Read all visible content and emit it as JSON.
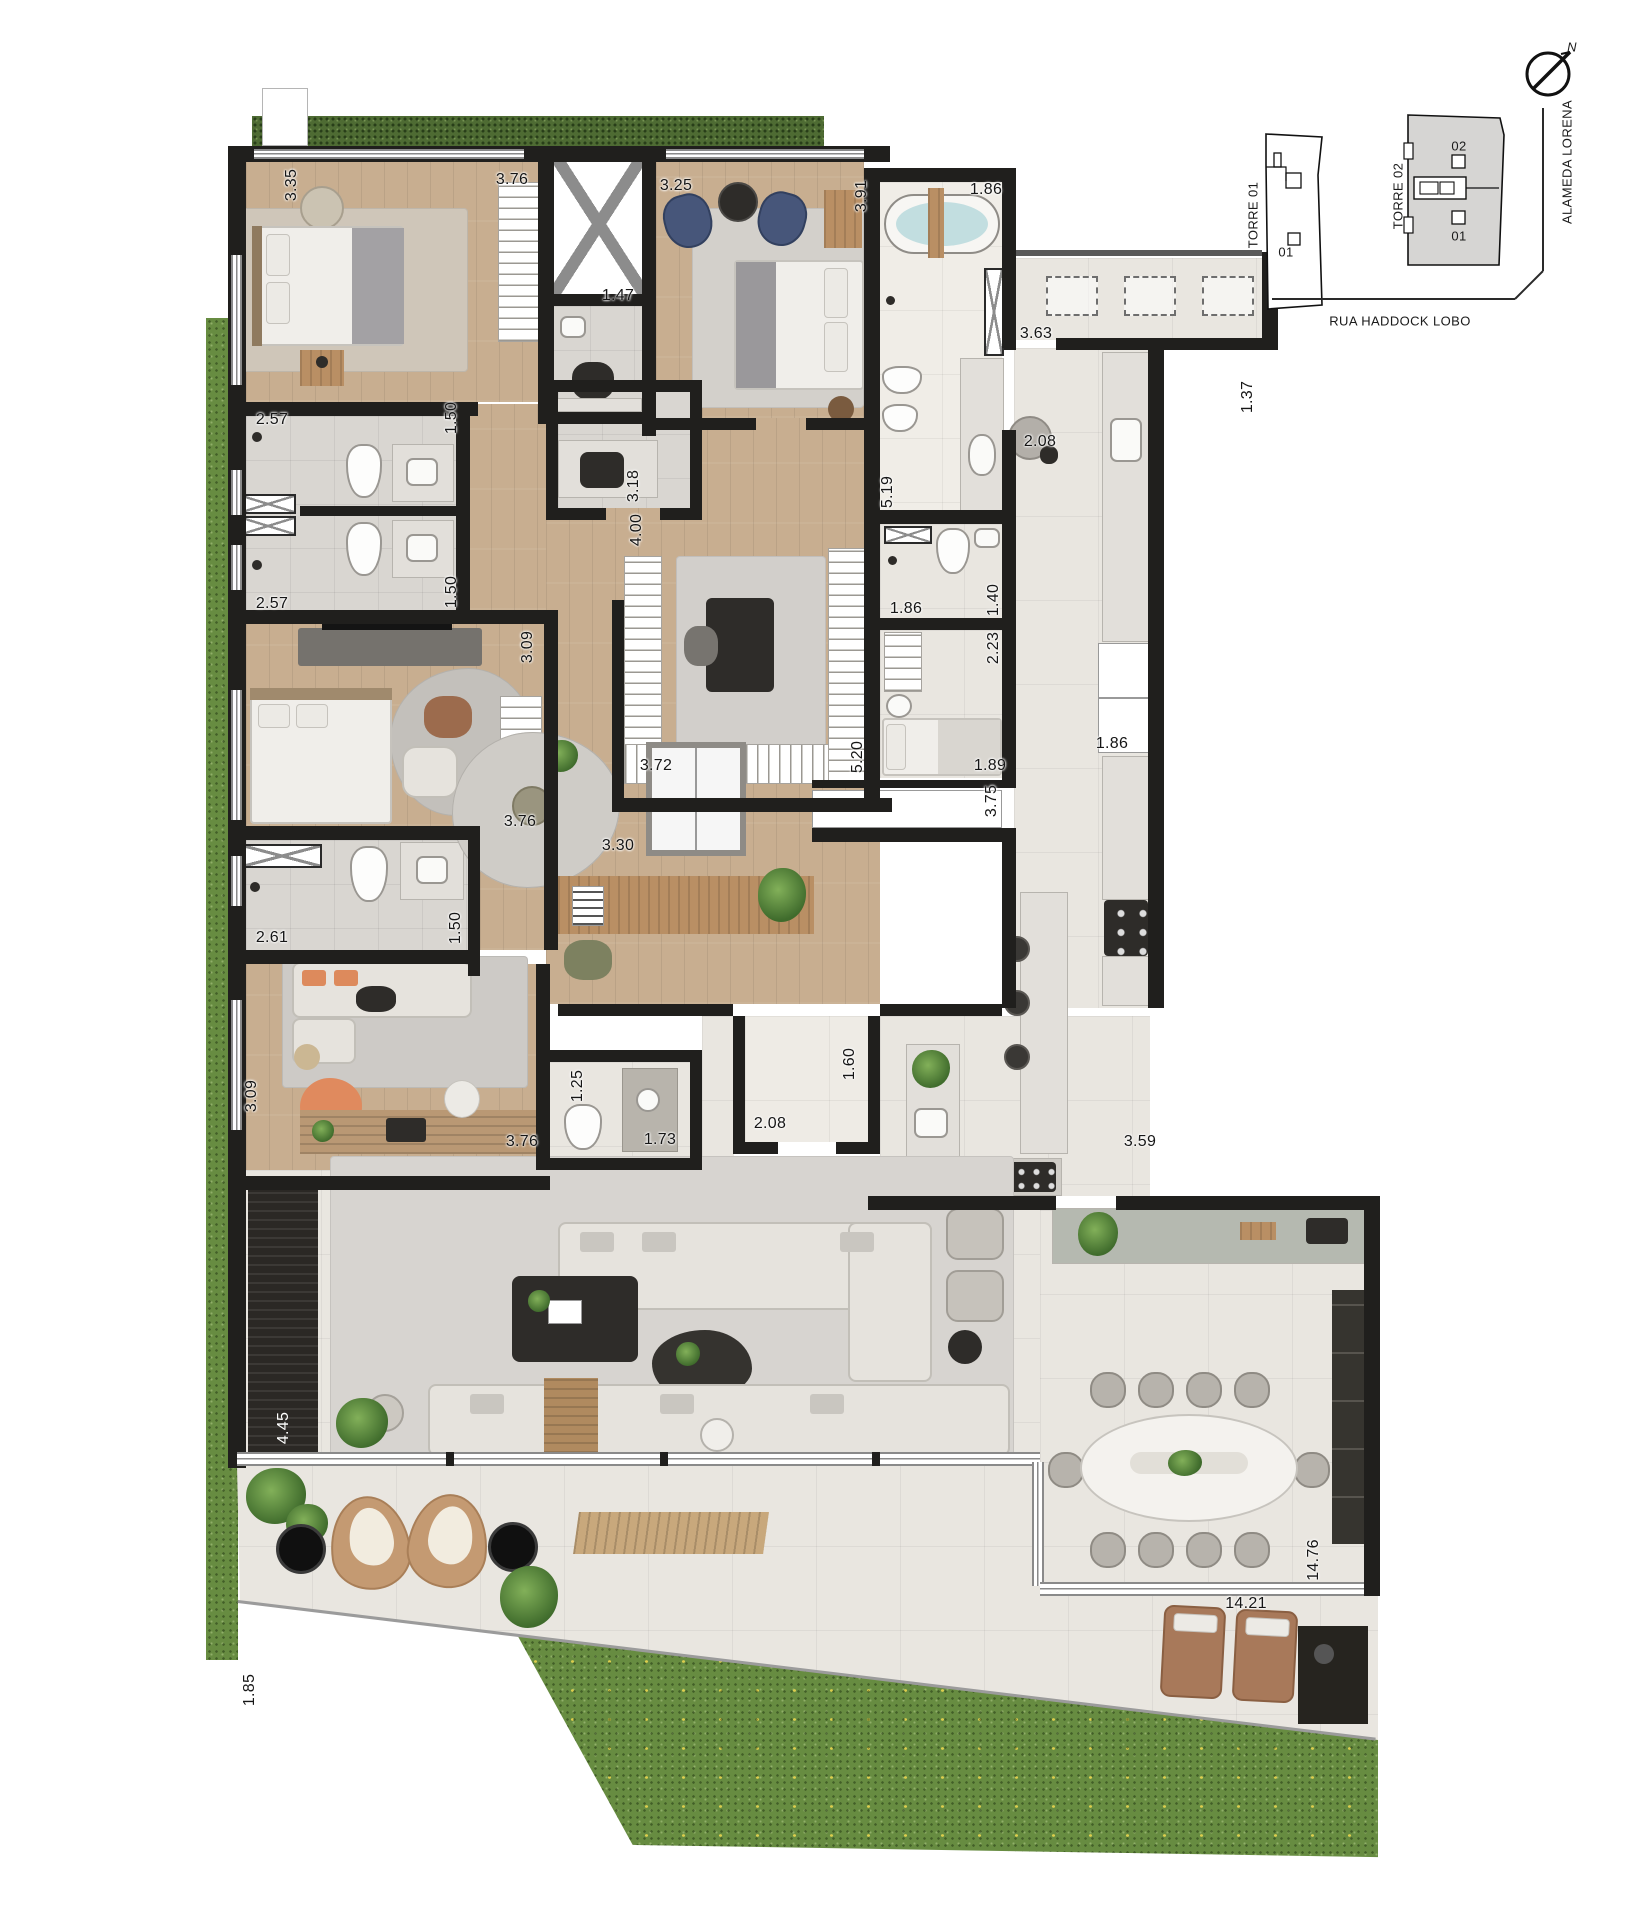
{
  "key_plan": {
    "torre1": "TORRE 01",
    "torre1_unit": "01",
    "torre2": "TORRE 02",
    "torre2_unit_top": "02",
    "torre2_unit_bottom": "01",
    "street_side": "ALAMEDA LORENA",
    "street_bottom": "RUA HADDOCK LOBO",
    "north": "N"
  },
  "dimensions": [
    {
      "t": "3.35",
      "x": 292,
      "y": 185,
      "v": 1
    },
    {
      "t": "3.76",
      "x": 512,
      "y": 180
    },
    {
      "t": "1.47",
      "x": 618,
      "y": 296
    },
    {
      "t": "3.25",
      "x": 676,
      "y": 186
    },
    {
      "t": "3.91",
      "x": 862,
      "y": 196,
      "v": 1
    },
    {
      "t": "1.86",
      "x": 986,
      "y": 190
    },
    {
      "t": "3.63",
      "x": 1036,
      "y": 334
    },
    {
      "t": "1.37",
      "x": 1248,
      "y": 397,
      "v": 1
    },
    {
      "t": "2.08",
      "x": 1040,
      "y": 442
    },
    {
      "t": "2.57",
      "x": 272,
      "y": 420
    },
    {
      "t": "1.50",
      "x": 452,
      "y": 418,
      "v": 1
    },
    {
      "t": "3.18",
      "x": 634,
      "y": 486,
      "v": 1
    },
    {
      "t": "2.57",
      "x": 272,
      "y": 604
    },
    {
      "t": "1.50",
      "x": 452,
      "y": 592,
      "v": 1
    },
    {
      "t": "4.00",
      "x": 637,
      "y": 530,
      "v": 1
    },
    {
      "t": "5.19",
      "x": 888,
      "y": 492,
      "v": 1
    },
    {
      "t": "1.86",
      "x": 906,
      "y": 609
    },
    {
      "t": "1.40",
      "x": 994,
      "y": 600,
      "v": 1
    },
    {
      "t": "2.23",
      "x": 994,
      "y": 648,
      "v": 1
    },
    {
      "t": "3.09",
      "x": 528,
      "y": 647,
      "v": 1
    },
    {
      "t": "3.72",
      "x": 656,
      "y": 766
    },
    {
      "t": "5.20",
      "x": 858,
      "y": 757,
      "v": 1
    },
    {
      "t": "1.89",
      "x": 990,
      "y": 766
    },
    {
      "t": "3.75",
      "x": 992,
      "y": 801,
      "v": 1
    },
    {
      "t": "1.86",
      "x": 1112,
      "y": 744
    },
    {
      "t": "3.76",
      "x": 520,
      "y": 822
    },
    {
      "t": "2.61",
      "x": 272,
      "y": 938
    },
    {
      "t": "1.50",
      "x": 456,
      "y": 928,
      "v": 1
    },
    {
      "t": "3.09",
      "x": 252,
      "y": 1096,
      "v": 1
    },
    {
      "t": "3.76",
      "x": 522,
      "y": 1142
    },
    {
      "t": "1.25",
      "x": 578,
      "y": 1086,
      "v": 1
    },
    {
      "t": "1.73",
      "x": 660,
      "y": 1140
    },
    {
      "t": "3.30",
      "x": 618,
      "y": 846
    },
    {
      "t": "2.08",
      "x": 770,
      "y": 1124
    },
    {
      "t": "1.60",
      "x": 850,
      "y": 1064,
      "v": 1
    },
    {
      "t": "3.59",
      "x": 1140,
      "y": 1142
    },
    {
      "t": "4.45",
      "x": 284,
      "y": 1428,
      "v": 1,
      "w": 1
    },
    {
      "t": "14.76",
      "x": 1314,
      "y": 1560,
      "v": 1
    },
    {
      "t": "14.21",
      "x": 1246,
      "y": 1604
    },
    {
      "t": "1.85",
      "x": 250,
      "y": 1690,
      "v": 1
    }
  ]
}
